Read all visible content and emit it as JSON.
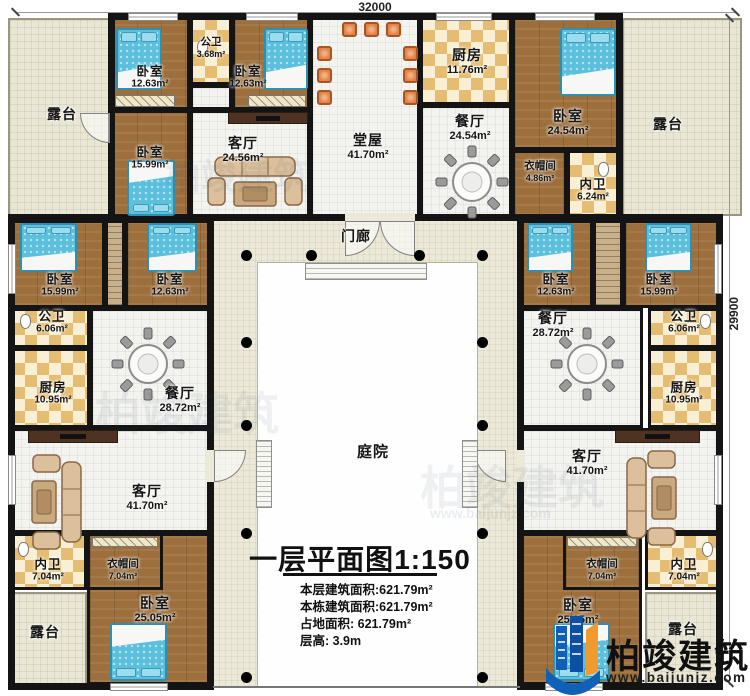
{
  "dimensions": {
    "top": "32000",
    "right": "29900"
  },
  "rooms": {
    "terrace_tl": {
      "name": "露台"
    },
    "terrace_tr": {
      "name": "露台"
    },
    "terrace_bl": {
      "name": "露台"
    },
    "terrace_br": {
      "name": "露台"
    },
    "bedroom_tl1": {
      "name": "卧室",
      "area": "12.63m²"
    },
    "bath_top": {
      "name": "公卫",
      "area": "3.68m²"
    },
    "bedroom_tl2": {
      "name": "卧室",
      "area": "12.63m²"
    },
    "bedroom_tl3": {
      "name": "卧室",
      "area": "15.99m²"
    },
    "living_tl": {
      "name": "客厅",
      "area": "24.56m²"
    },
    "hall": {
      "name": "堂屋",
      "area": "41.70m²"
    },
    "kitchen_top": {
      "name": "厨房",
      "area": "11.76m²"
    },
    "dining_top": {
      "name": "餐厅",
      "area": "24.54m²"
    },
    "bedroom_tr": {
      "name": "卧室",
      "area": "24.54m²"
    },
    "cloak_tr": {
      "name": "衣帽间",
      "area": "4.86m²"
    },
    "bath_tr": {
      "name": "内卫",
      "area": "6.24m²"
    },
    "porch": {
      "name": "门廊"
    },
    "bedroom_l1": {
      "name": "卧室",
      "area": "15.99m²"
    },
    "bedroom_l2": {
      "name": "卧室",
      "area": "12.63m²"
    },
    "bath_l": {
      "name": "公卫",
      "area": "6.06m²"
    },
    "kitchen_l": {
      "name": "厨房",
      "area": "10.95m²"
    },
    "dining_l": {
      "name": "餐厅",
      "area": "28.72m²"
    },
    "living_l": {
      "name": "客厅",
      "area": "41.70m²"
    },
    "bath_bl": {
      "name": "内卫",
      "area": "7.04m²"
    },
    "cloak_bl": {
      "name": "衣帽间",
      "area": "7.04m²"
    },
    "bedroom_bl": {
      "name": "卧室",
      "area": "25.05m²"
    },
    "bedroom_r1": {
      "name": "卧室",
      "area": "12.63m²"
    },
    "bedroom_r2": {
      "name": "卧室",
      "area": "15.99m²"
    },
    "dining_r": {
      "name": "餐厅",
      "area": "28.72m²"
    },
    "bath_r": {
      "name": "公卫",
      "area": "6.06m²"
    },
    "kitchen_r": {
      "name": "厨房",
      "area": "10.95m²"
    },
    "living_r": {
      "name": "客厅",
      "area": "41.70m²"
    },
    "cloak_br": {
      "name": "衣帽间",
      "area": "7.04m²"
    },
    "bath_br": {
      "name": "内卫",
      "area": "7.04m²"
    },
    "bedroom_br": {
      "name": "卧室",
      "area": "25.05m²"
    },
    "courtyard": {
      "name": "庭院"
    }
  },
  "title_block": {
    "title": "一层平面图",
    "scale": "1:150",
    "lines": [
      "本层建筑面积:621.79m²",
      "本栋建筑面积:621.79m²",
      "占地面积: 621.79m²",
      "层高: 3.9m"
    ]
  },
  "watermark": {
    "brand": "柏竣建筑",
    "url": "www.baijunjz.com"
  },
  "colors": {
    "wall": "#141414",
    "wood_floor": "#9c6f3c",
    "tile_floor": "#f3f3f0",
    "terrace_floor": "#e9e6d3",
    "checker_dark": "#e5bd72",
    "checker_light": "#f8efd4",
    "walkway": "#ece9d8",
    "bed_blue": "#5cc0dd",
    "chair_orange": "#e2834a",
    "logo_blue": "#1060b8",
    "logo_orange": "#f29a2e"
  }
}
